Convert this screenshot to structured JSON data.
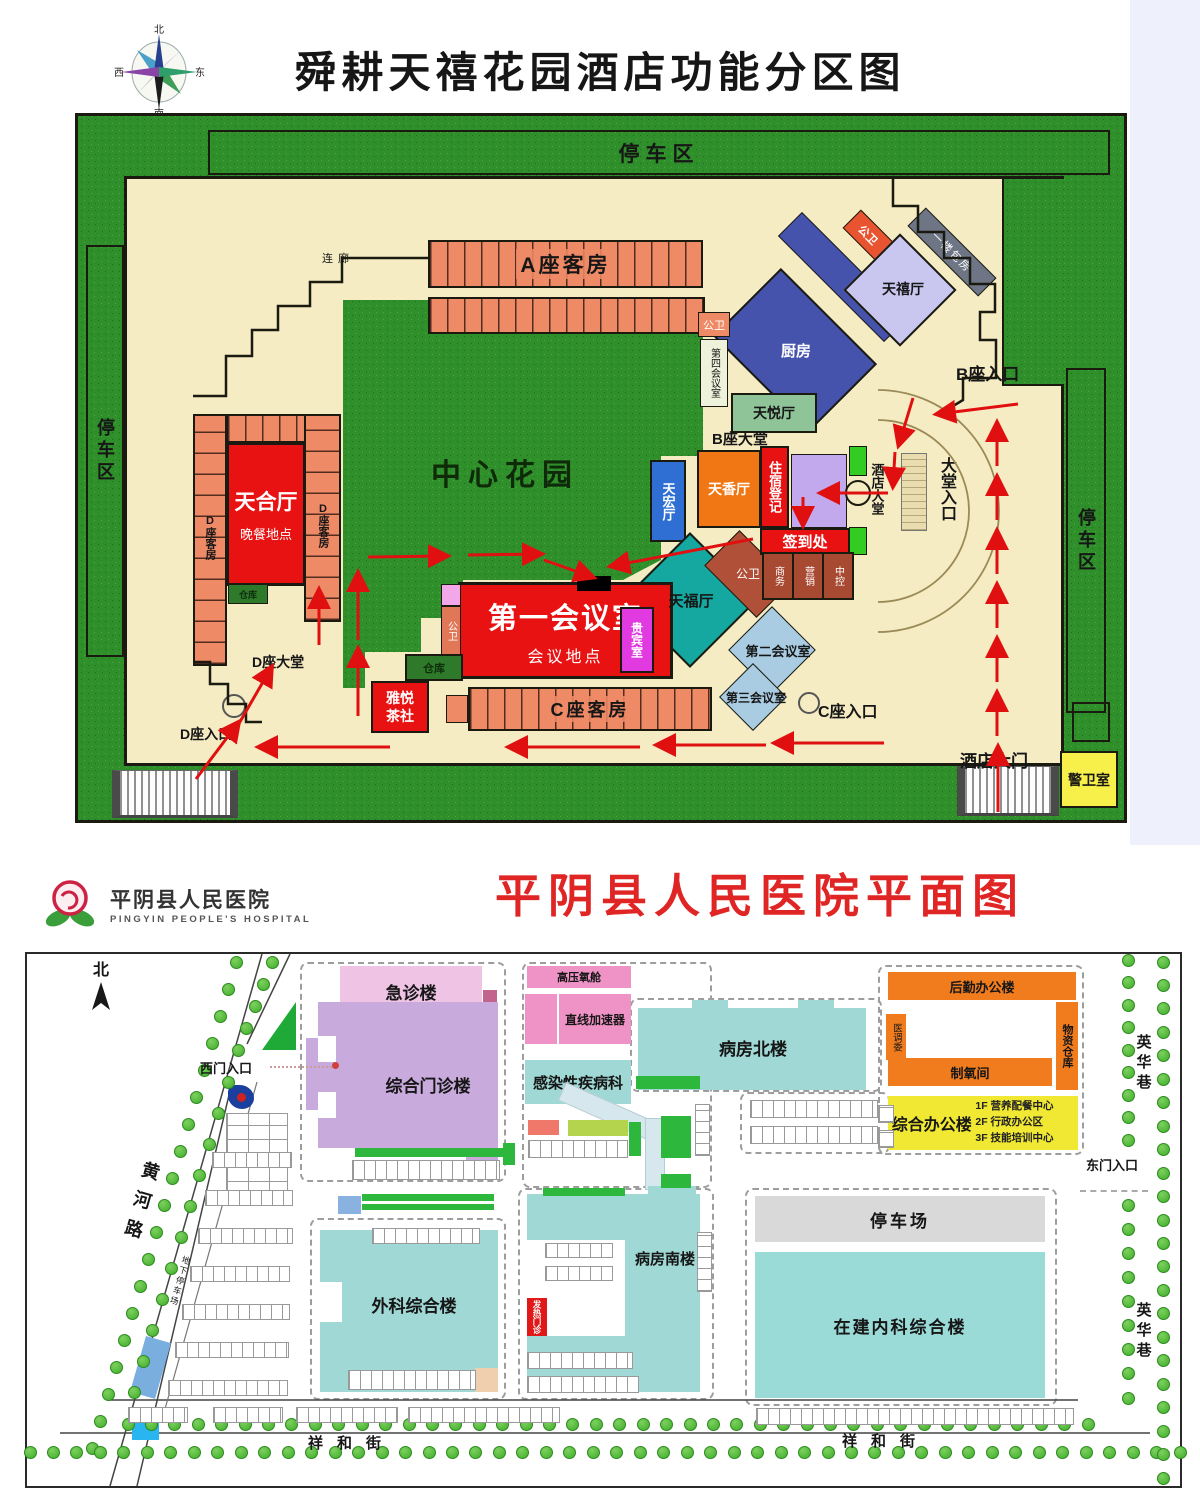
{
  "hotel": {
    "title": "舜耕天禧花园酒店功能分区图",
    "compass": {
      "n": "北",
      "s": "南",
      "e": "东",
      "w": "西"
    },
    "labels": {
      "parkingTop": "停车区",
      "parkingLeft": "停车区",
      "parkingRight": "停车区",
      "corridor": "连廊",
      "blockA": "A座客房",
      "wc1": "公卫",
      "wc2": "公卫",
      "wc3": "公卫",
      "wc4": "公卫",
      "tianxiHall": "天禧厅",
      "floorRooms": "一楼包房",
      "kitchen": "厨房",
      "bLobby": "B座大堂",
      "bEntrance": "B座入口",
      "meeting4": "第四会议室",
      "tianyueHall": "天悦厅",
      "garden": "中心花园",
      "tianxiangHall": "天香厅",
      "lodging": "住宿登记",
      "checkin": "签到处",
      "hotelLobby": "酒店大堂",
      "lobbyEntrance": "大堂入口",
      "tianhongHall": "天宏厅",
      "tianfuHall": "天福厅",
      "biz": "商务",
      "marketing": "营销",
      "control": "中控",
      "meeting2": "第二会议室",
      "meeting3": "第三会议室",
      "cEntrance": "C座入口",
      "cRooms": "C座客房",
      "meeting1": "第一会议室",
      "meeting1Sub": "会议地点",
      "vip": "贵宾室",
      "store1": "仓库",
      "store2": "仓库",
      "teahouse": "雅悦茶社",
      "tianheHall": "天合厅",
      "tianheSub": "晚餐地点",
      "dRoomsL": "D座客房",
      "dRoomsR": "D座客房",
      "dLobby": "D座大堂",
      "dEntrance": "D座入口",
      "hotelGate": "酒店大门",
      "guard": "警卫室"
    }
  },
  "hospital": {
    "logo": {
      "cn": "平阴县人民医院",
      "en": "PINGYIN PEOPLE'S HOSPITAL"
    },
    "title": "平阴县人民医院平面图",
    "labels": {
      "north": "北",
      "westEntrance": "西门入口",
      "emergency": "急诊楼",
      "outpatient": "综合门诊楼",
      "hyperbaric": "高压氧舱",
      "linac": "直线加速器",
      "infectious": "感染性疾病科",
      "wardNorth": "病房北楼",
      "logistics": "后勤办公楼",
      "warehouse": "物资仓库",
      "medCommittee": "医调委",
      "oxygen": "制氧间",
      "admin": "综合办公楼",
      "adminF1": "1F 营养配餐中心",
      "adminF2": "2F 行政办公区",
      "adminF3": "3F 技能培训中心",
      "eastEntrance": "东门入口",
      "parkingLot": "停车场",
      "internalMed": "在建内科综合楼",
      "surgery": "外科综合楼",
      "wardSouth": "病房南楼",
      "feverClinic": "发热门诊",
      "undergroundParking": "地下停车场",
      "huangheRoad": "黄河路",
      "yinghua1": "英华巷",
      "yinghua2": "英华巷",
      "xianghe1": "祥和街",
      "xianghe2": "祥和街"
    }
  }
}
